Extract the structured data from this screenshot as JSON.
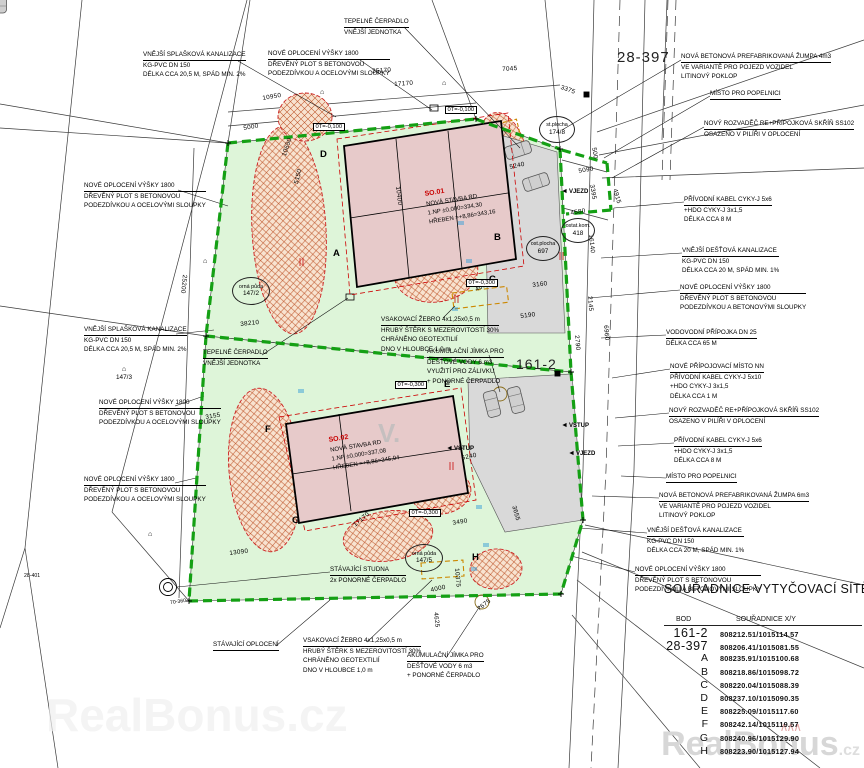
{
  "annotations": [
    {
      "id": "kanalizace-splaskova-top",
      "lines": [
        "VNĚJŠÍ SPLAŠKOVÁ KANALIZACE",
        "KG-PVC DN 150",
        "DÉLKA CCA 20,5 M, SPÁD MIN. 2%"
      ]
    },
    {
      "id": "oploceni-top",
      "lines": [
        "NOVÉ OPLOCENÍ VÝŠKY 1800",
        "DŘEVĚNÝ PLOT S BETONOVOU",
        "PODEZDÍVKOU A OCELOVÝMI SLOUPKY"
      ]
    },
    {
      "id": "tepelne-cerpadlo-top",
      "lines": [
        "TEPELNÉ ČERPADLO",
        "VNĚJŠÍ JEDNOTKA"
      ]
    },
    {
      "id": "zumpa-top",
      "lines": [
        "NOVÁ BETONOVÁ PREFABRIKOVANÁ ŽUMPA 4m3",
        "VE VARIANTĚ PRO POJEZD VOZIDEL",
        "LITINOVÝ POKLOP"
      ]
    },
    {
      "id": "popelnice-top",
      "lines": [
        "MÍSTO PRO POPELNICI"
      ]
    },
    {
      "id": "rozvadec-top",
      "lines": [
        "NOVÝ ROZVADĚČ RE+PŘÍPOJKOVÁ SKŘÍŇ SS102",
        "OSAZENO V PILÍŘI V OPLOCENÍ"
      ]
    },
    {
      "id": "kabel-1",
      "lines": [
        "PŘÍVODNÍ KABEL CYKY-J 5x6",
        "+HDO CYKY-J 3x1,5",
        "DÉLKA CCA 8 M"
      ]
    },
    {
      "id": "destova-1",
      "lines": [
        "VNĚJŠÍ DEŠŤOVÁ KANALIZACE",
        "KG-PVC DN 150",
        "DÉLKA CCA 20 M, SPÁD MIN. 1%"
      ]
    },
    {
      "id": "oploceni-beton-1",
      "lines": [
        "NOVÉ OPLOCENÍ VÝŠKY 1800",
        "DŘEVĚNÝ PLOT S BETONOVOU",
        "PODEZDÍVKOU A BETONOVÝMI SLOUPKY"
      ]
    },
    {
      "id": "vodovod",
      "lines": [
        "VODOVODNÍ PŘÍPOJKA DN 25",
        "DÉLKA CCA 65 M"
      ]
    },
    {
      "id": "pripojovaci-misto",
      "lines": [
        "NOVÉ PŘÍPOJOVACÍ MÍSTO NN",
        "PŘÍVODNÍ KABEL CYKY-J 5x10",
        "+HDO CYKY-J 3x1,5",
        "DÉLKA CCA 1 M"
      ]
    },
    {
      "id": "rozvadec-2",
      "lines": [
        "NOVÝ ROZVADĚČ RE+PŘÍPOJKOVÁ SKŘÍŇ SS102",
        "OSAZENO V PILÍŘI V OPLOCENÍ"
      ]
    },
    {
      "id": "kabel-2",
      "lines": [
        "PŘÍVODNÍ KABEL CYKY-J 5x6",
        "+HDO CYKY-J 3x1,5",
        "DÉLKA CCA 8 M"
      ]
    },
    {
      "id": "popelnice-2",
      "lines": [
        "MÍSTO PRO POPELNICI"
      ]
    },
    {
      "id": "zumpa-2",
      "lines": [
        "NOVÁ BETONOVÁ PREFABRIKOVANÁ ŽUMPA 6m3",
        "VE VARIANTĚ PRO POJEZD VOZIDEL",
        "LITINOVÝ POKLOP"
      ]
    },
    {
      "id": "destova-2",
      "lines": [
        "VNĚJŠÍ DEŠŤOVÁ KANALIZACE",
        "KG-PVC DN 150",
        "DÉLKA CCA 20 M, SPÁD MIN. 1%"
      ]
    },
    {
      "id": "oploceni-beton-2",
      "lines": [
        "NOVÉ OPLOCENÍ VÝŠKY 1800",
        "DŘEVĚNÝ PLOT S BETONOVOU",
        "PODEZDÍVKOU A BETONOVÝMI SLOUPKY"
      ]
    },
    {
      "id": "oploceni-left-1",
      "lines": [
        "NOVÉ OPLOCENÍ VÝŠKY 1800",
        "DŘEVĚNÝ PLOT S BETONOVOU",
        "PODEZDÍVKOU A OCELOVÝMI SLOUPKY"
      ]
    },
    {
      "id": "splaskova-left",
      "lines": [
        "VNĚJŠÍ SPLAŠKOVÁ KANALIZACE",
        "KG-PVC DN 150",
        "DÉLKA CCA 20,5 M, SPÁD MIN. 2%"
      ]
    },
    {
      "id": "tepelne-cerpadlo-left",
      "lines": [
        "TEPELNÉ ČERPADLO",
        "VNĚJŠÍ JEDNOTKA"
      ]
    },
    {
      "id": "oploceni-left-2",
      "lines": [
        "NOVÉ OPLOCENÍ VÝŠKY 1800",
        "DŘEVĚNÝ PLOT S BETONOVOU",
        "PODEZDÍVKOU A OCELOVÝMI SLOUPKY"
      ]
    },
    {
      "id": "oploceni-left-3",
      "lines": [
        "NOVÉ OPLOCENÍ VÝŠKY 1800",
        "DŘEVĚNÝ PLOT S BETONOVOU",
        "PODEZDÍVKOU A OCELOVÝMI SLOUPKY"
      ]
    },
    {
      "id": "vsakovaci-zebro-1",
      "lines": [
        "VSAKOVACÍ ŽEBRO 4x1,25x0,5 m",
        "HRUBÝ ŠTĚRK S MEZEROVITOSTÍ 30%",
        "CHRÁNĚNO GEOTEXTILIÍ",
        "DNO V HLOUBCE 1,0 m"
      ]
    },
    {
      "id": "jimka-1",
      "lines": [
        "AKUMULAČNÍ JÍMKA PRO",
        "DEŠŤOVÉ VODY 6 m3",
        "VYUŽITÍ PRO ZÁLIVKU",
        "+ PONORNÉ ČERPADLO"
      ]
    },
    {
      "id": "studna",
      "lines": [
        "STÁVAJÍCÍ STUDNA",
        "2x PONORNÉ ČERPADLO"
      ]
    },
    {
      "id": "stavajici-oploceni",
      "lines": [
        "STÁVAJÍCÍ OPLOCENÍ"
      ]
    },
    {
      "id": "vsakovaci-zebro-2",
      "lines": [
        "VSAKOVACÍ ŽEBRO 4x1,25x0,5 m",
        "HRUBÝ ŠTĚRK S MEZEROVITOSTÍ 30%",
        "CHRÁNĚNO GEOTEXTILIÍ",
        "DNO V HLOUBCE 1,0 m"
      ]
    },
    {
      "id": "jimka-2",
      "lines": [
        "AKUMULAČNÍ JÍMKA PRO",
        "DEŠŤOVÉ VODY 6 m3",
        "+ PONORNÉ ČERPADLO"
      ]
    }
  ],
  "buildings": {
    "so01": {
      "code": "SO.01",
      "name": "NOVÁ STAVBA RD",
      "floor": "1.NP   ±0,000=334,30",
      "ridge": "HŘEBEN   =+8,86=343,16"
    },
    "so02": {
      "code": "SO.02",
      "name": "NOVÁ STAVBA RD",
      "floor": "1.NP   ±0,000=337,08",
      "ridge": "HŘEBEN   =+8,86=345,94"
    }
  },
  "major_points": {
    "p161": "161-2",
    "p28": "28-397"
  },
  "corner_letters": [
    "A",
    "B",
    "C",
    "D",
    "E",
    "F",
    "G",
    "H"
  ],
  "dims": [
    "35170",
    "17170",
    "10950",
    "5000",
    "7045",
    "3375",
    "25200",
    "38210",
    "3155",
    "5150",
    "10650",
    "10400",
    "5240",
    "5090",
    "4580",
    "4915",
    "3395",
    "16140",
    "3160",
    "5190",
    "4000",
    "5240",
    "3490",
    "3655",
    "13090",
    "17170",
    "4000",
    "4625",
    "7675",
    "10375",
    "6960",
    "2790",
    "500",
    "2145"
  ],
  "elevations": [
    "0T=-0,100",
    "0T=-0,100",
    "0T=-0,300",
    "0T=-0,300",
    "0T=-0,300"
  ],
  "access": [
    "VJEZD",
    "VSTUP",
    "VSTUP",
    "VJEZD"
  ],
  "parcels": [
    {
      "name": "orná půda",
      "number": "147/2"
    },
    {
      "name": "",
      "number": "147/3"
    },
    {
      "name": "orná půda",
      "number": "147/5"
    },
    {
      "name": "ost.plocha",
      "number": "697"
    },
    {
      "name": "ostat.kom.",
      "number": "418"
    },
    {
      "name": "st.plocha",
      "number": "174/8"
    }
  ],
  "small_points": [
    "28-401",
    "70-360"
  ],
  "icons": {
    "triangle_left": "◄",
    "house_mark": "⌂"
  },
  "table": {
    "title": "SOUŘADNICE VYTYČOVACÍ SÍTĚ",
    "col_bod": "BOD",
    "col_xy": "SOUŘADNICE X/Y",
    "rows": [
      {
        "bod": "161-2",
        "xy": "808212.51/1015114.57"
      },
      {
        "bod": "28-397",
        "xy": "808206.41/1015081.55"
      },
      {
        "bod": "A",
        "xy": "808235.91/1015100.68"
      },
      {
        "bod": "B",
        "xy": "808218.86/1015098.72"
      },
      {
        "bod": "C",
        "xy": "808220.04/1015088.39"
      },
      {
        "bod": "D",
        "xy": "808237.10/1015090.35"
      },
      {
        "bod": "E",
        "xy": "808225.09/1015117.60"
      },
      {
        "bod": "F",
        "xy": "808242.14/1015119.57"
      },
      {
        "bod": "G",
        "xy": "808240.96/1015129.90"
      },
      {
        "bod": "H",
        "xy": "808223.90/1015127.94"
      }
    ]
  },
  "watermark": {
    "brand": "RealBonus",
    "tld": ".cz",
    "roof": "∧∧∧",
    "mid": "V.",
    "low": "RealBonus.cz"
  },
  "colors": {
    "fence_green": "#14a014",
    "plot_green": "#def5d9",
    "building_pink": "#e7caca",
    "hatch_red": "#c05a30",
    "accent_red": "#c90000",
    "driveway_gray": "#d9d9d9"
  }
}
